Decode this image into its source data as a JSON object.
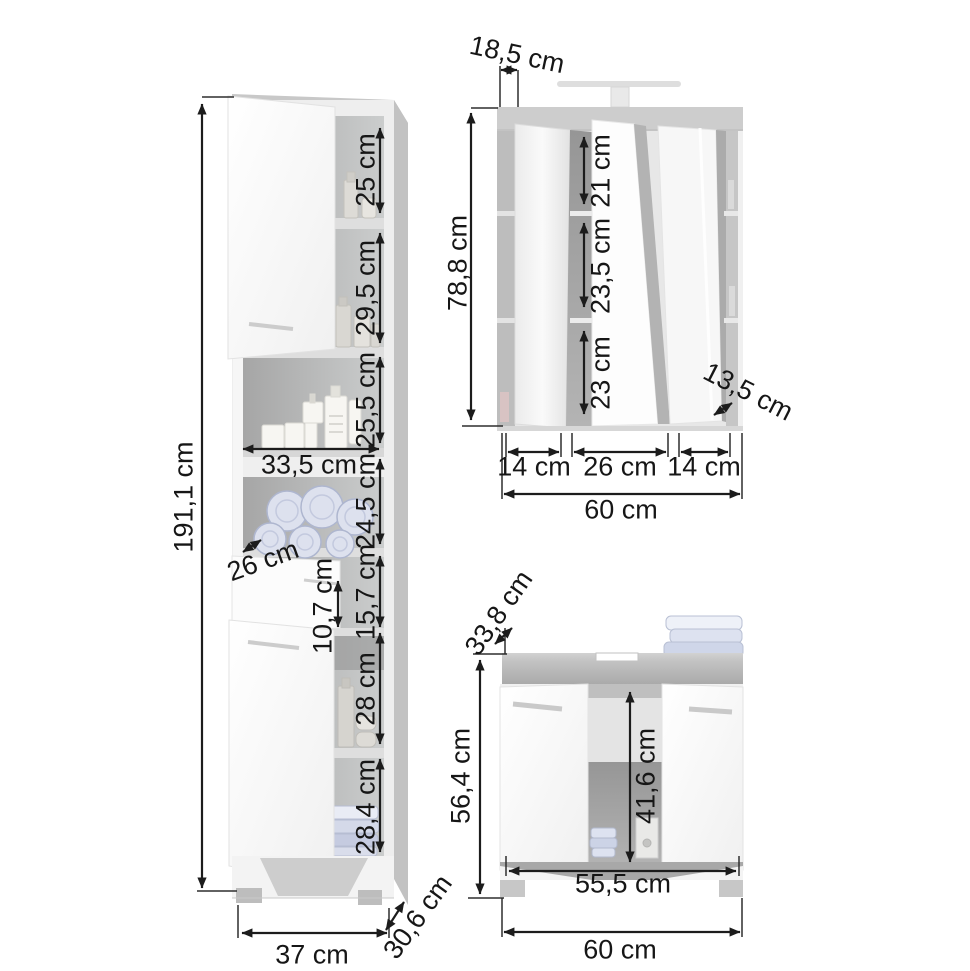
{
  "diagram_title": "Bathroom furniture set dimension drawing",
  "units": "cm",
  "colors": {
    "dimension_lines": "#1c1c1c",
    "wood_gray": "#c2c2c2",
    "towel_blue": "#d6dbea",
    "door_white": "#fbfbfb"
  },
  "tall_cabinet": {
    "total_height": "191,1 cm",
    "section_1": "25 cm",
    "section_2": "29,5 cm",
    "section_3": "25,5 cm",
    "shelf_width": "33,5 cm",
    "section_4": "24,5 cm",
    "shelf_depth": "26 cm",
    "drawer_inner": "10,7 cm",
    "drawer_section": "15,7 cm",
    "section_5": "28 cm",
    "section_6": "28,4 cm",
    "width": "37 cm",
    "depth": "30,6 cm"
  },
  "mirror_cabinet": {
    "top_depth": "18,5 cm",
    "height": "78,8 cm",
    "compartment_1": "21 cm",
    "compartment_2": "23,5 cm",
    "compartment_3": "23 cm",
    "side_depth": "13,5 cm",
    "door_left": "14 cm",
    "door_center": "26 cm",
    "door_right": "14 cm",
    "width": "60 cm"
  },
  "vanity_cabinet": {
    "top_depth": "33,8 cm",
    "height": "56,4 cm",
    "inner_height": "41,6 cm",
    "inner_width": "55,5 cm",
    "width": "60 cm"
  }
}
